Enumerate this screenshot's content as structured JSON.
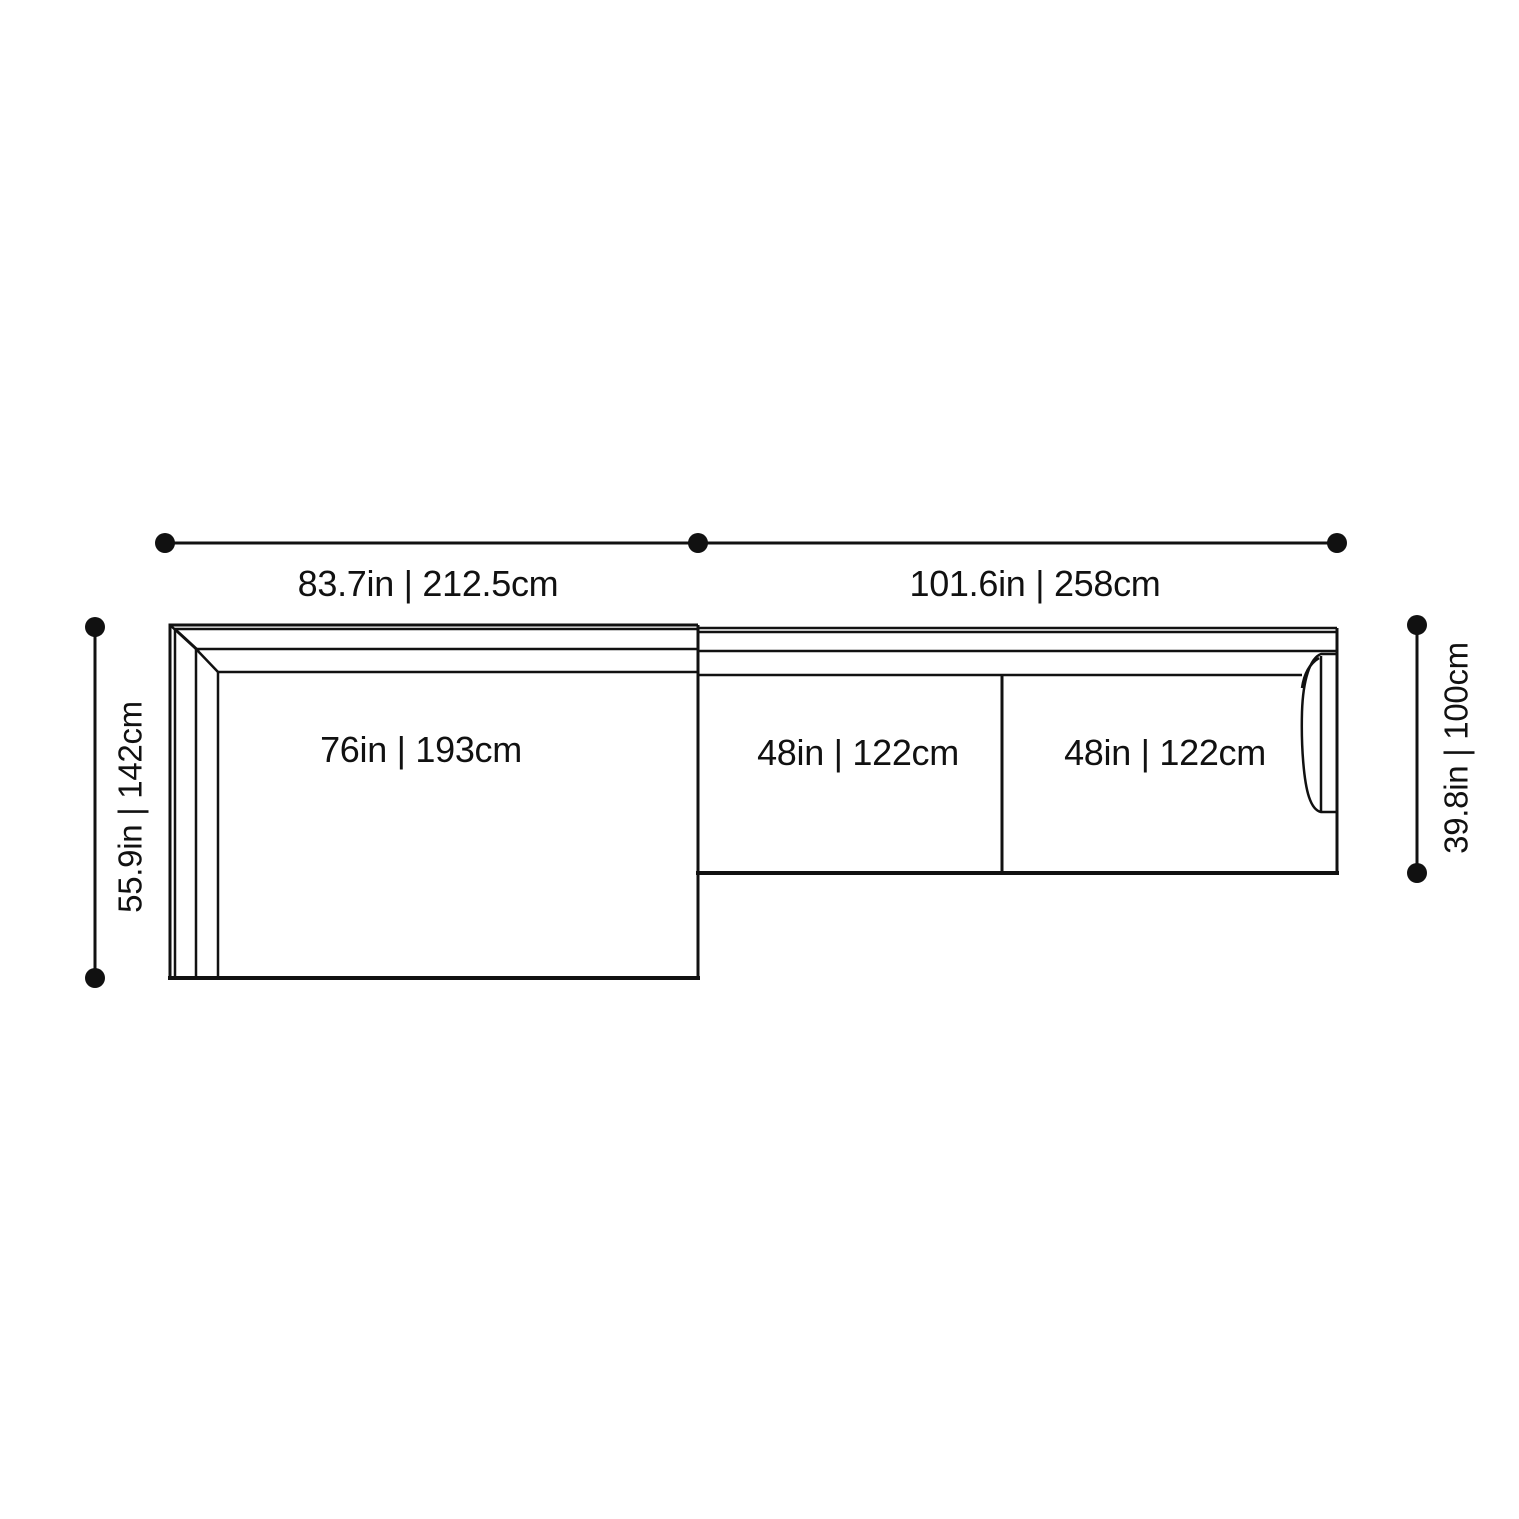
{
  "diagram": {
    "type": "furniture-dimension-drawing",
    "subject": "sectional sofa with chaise, top view",
    "colors": {
      "line": "#111111",
      "text": "#111111",
      "background": "#ffffff"
    },
    "dimensions": {
      "top_left_width": {
        "label": "83.7in | 212.5cm"
      },
      "top_right_width": {
        "label": "101.6in | 258cm"
      },
      "left_depth": {
        "label": "55.9in | 142cm"
      },
      "right_depth": {
        "label": "39.8in | 100cm"
      }
    },
    "sections": {
      "chaise": {
        "label": "76in | 193cm"
      },
      "middle_seat": {
        "label": "48in | 122cm"
      },
      "right_seat": {
        "label": "48in | 122cm"
      }
    }
  }
}
